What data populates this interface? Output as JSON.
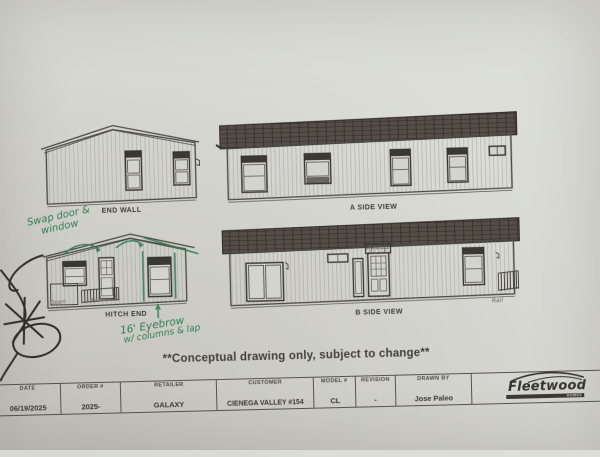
{
  "colors": {
    "paper": "#d7d8d2",
    "ink": "#3e3d38",
    "line": "#55534e",
    "siding": "#8f8f87",
    "roof_dark": "#554e46",
    "roof_line": "#2e2a26",
    "green": "#2f7d4f",
    "pencil": "#6e6c64",
    "doodle": "#221f1b"
  },
  "note": "**Conceptual drawing only, subject to change**",
  "views": {
    "end_wall": {
      "label": "END WALL"
    },
    "a_side": {
      "label": "A SIDE VIEW"
    },
    "hitch_end": {
      "label": "HITCH END"
    },
    "b_side": {
      "label": "B SIDE VIEW"
    }
  },
  "handwriting": {
    "swap_note_line1": "Swap door &",
    "swap_note_line2": "window",
    "eyebrow_note_line1": "16' Eyebrow",
    "eyebrow_note_line2": "w/ columns & lap",
    "hitch_open_label": "Open",
    "hitch_rail_label": "Rail",
    "bside_rail_label": "Rail"
  },
  "title_block": {
    "columns": [
      {
        "header": "DATE",
        "value": "06/19/2025"
      },
      {
        "header": "ORDER #",
        "value": "2025-"
      },
      {
        "header": "RETAILER",
        "value": "GALAXY"
      },
      {
        "header": "CUSTOMER",
        "value": "CIENEGA VALLEY #154"
      },
      {
        "header": "MODEL #",
        "value": "CL"
      },
      {
        "header": "REVISION",
        "value": "-"
      },
      {
        "header": "DRAWN BY",
        "value": "Jose Paleo"
      }
    ],
    "logo": {
      "brand": "Fleetwood",
      "sub": "HOMES"
    }
  }
}
